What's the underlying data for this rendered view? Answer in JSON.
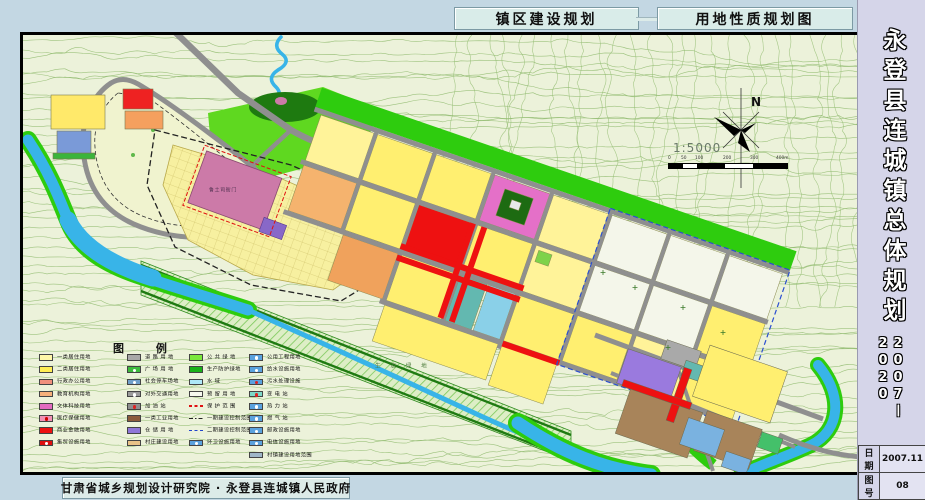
{
  "header": {
    "title_left": "镇区建设规划",
    "title_right": "用地性质规划图"
  },
  "sidebar": {
    "title": "永登县连城镇总体规划",
    "period_start": "2007",
    "period_dash": "—",
    "period_end": "2020",
    "table": {
      "date_label": "日期",
      "date_value": "2007.11",
      "number_label": "图号",
      "number_value": "08"
    }
  },
  "footer": {
    "credit": "甘肃省城乡规划设计研究院 · 永登县连城镇人民政府"
  },
  "map": {
    "labels": {
      "heritage": "鲁土司衙门",
      "eco_green": "生 态 绿 地",
      "north": "N",
      "scale": "1:5000",
      "scale_ticks": [
        "0",
        "50",
        "100",
        "200",
        "300",
        "400m"
      ]
    },
    "legend": {
      "title": "图 例",
      "columns": [
        {
          "items": [
            {
              "label": "一类居住用地",
              "type": "fill",
              "swatch": "#fff8a8"
            },
            {
              "label": "二类居住用地",
              "type": "fill",
              "swatch": "#ffee55"
            },
            {
              "label": "行政办公用地",
              "type": "fill",
              "swatch": "#f0907c"
            },
            {
              "label": "教育机构用地",
              "type": "fill",
              "swatch": "#f6b07a"
            },
            {
              "label": "文体科技用地",
              "type": "fill",
              "swatch": "#e36bc0"
            },
            {
              "label": "医疗保健用地",
              "type": "fill-dot",
              "swatch": "#f291b4",
              "dot": "#d00000"
            },
            {
              "label": "商业金融用地",
              "type": "fill",
              "swatch": "#ee1111"
            },
            {
              "label": "集贸设施用地",
              "type": "fill-dot",
              "swatch": "#dd0f0f",
              "dot": "#ffffff"
            }
          ]
        },
        {
          "items": [
            {
              "label": "道 路 用 地",
              "type": "fill",
              "swatch": "#a8a8a8"
            },
            {
              "label": "广 场 用 地",
              "type": "fill-dot",
              "swatch": "#3dbb3d",
              "dot": "#ffffff"
            },
            {
              "label": "社会停车场地",
              "type": "fill-dot",
              "swatch": "#6f9fca",
              "dot": "#ffffff"
            },
            {
              "label": "对外交通用地",
              "type": "fill-dot",
              "swatch": "#9b9b9b",
              "dot": "#ffffff"
            },
            {
              "label": "加 油 站",
              "type": "fill-dot",
              "swatch": "#8f8f8f",
              "dot": "#dd2222"
            },
            {
              "label": "一类工业用地",
              "type": "fill",
              "swatch": "#8b5a3c"
            },
            {
              "label": "仓 储 用 地",
              "type": "fill",
              "swatch": "#8f76d8"
            },
            {
              "label": "村庄建设用地",
              "type": "fill",
              "swatch": "#e9c287"
            }
          ]
        },
        {
          "items": [
            {
              "label": "公 共 绿 地",
              "type": "fill",
              "swatch": "#7ae83c"
            },
            {
              "label": "生产防护绿地",
              "type": "fill",
              "swatch": "#19b219"
            },
            {
              "label": "水      域",
              "type": "fill",
              "swatch": "#aee8f8"
            },
            {
              "label": "预 留 用 地",
              "type": "fill",
              "swatch": "#f6f8ee"
            },
            {
              "label": "保 护 范 围",
              "type": "line",
              "line": "#e01010",
              "style": "dashed"
            },
            {
              "label": "一期建设控制范围",
              "type": "line",
              "line": "#222222",
              "style": "dashdot"
            },
            {
              "label": "二期建设控制范围",
              "type": "line",
              "line": "#2244cc",
              "style": "dashed"
            },
            {
              "label": "环卫设施用地",
              "type": "fill-dot",
              "swatch": "#5aa2de",
              "dot": "#ffffff"
            }
          ]
        },
        {
          "items": [
            {
              "label": "公用工程用地",
              "type": "fill-dot",
              "swatch": "#5aa2de",
              "dot": "#ffffff"
            },
            {
              "label": "给水设施用地",
              "type": "fill-dot",
              "swatch": "#5aa2de",
              "dot": "#ffffff"
            },
            {
              "label": "污水处理设施",
              "type": "fill-dot",
              "swatch": "#5aa2de",
              "dot": "#dd2222"
            },
            {
              "label": "变  电  站",
              "type": "fill-dot",
              "swatch": "#7ed8c8",
              "dot": "#dd2222"
            },
            {
              "label": "热  力  站",
              "type": "fill-dot",
              "swatch": "#5aa2de",
              "dot": "#ffffff"
            },
            {
              "label": "燃  气  站",
              "type": "fill-dot",
              "swatch": "#5aa2de",
              "dot": "#ffffff"
            },
            {
              "label": "邮政设施用地",
              "type": "fill-dot",
              "swatch": "#5aa2de",
              "dot": "#ffffff"
            },
            {
              "label": "电信设施用地",
              "type": "fill-dot",
              "swatch": "#5aa2de",
              "dot": "#ffffff"
            },
            {
              "label": "村镇建设用地范围",
              "type": "fill",
              "swatch": "#9fb6c8"
            }
          ]
        }
      ]
    }
  },
  "colors": {
    "page_bg": "#c3d7e3",
    "panel_bg": "#d9ece9",
    "sidebar_bg": "#d5d5e9",
    "topo_bg": "#ecf2da",
    "river": "#38b4e8",
    "greenbelt": "#2ecc0e",
    "commercial_red": "#ee1111",
    "heritage_pink": "#cc7aa8"
  }
}
